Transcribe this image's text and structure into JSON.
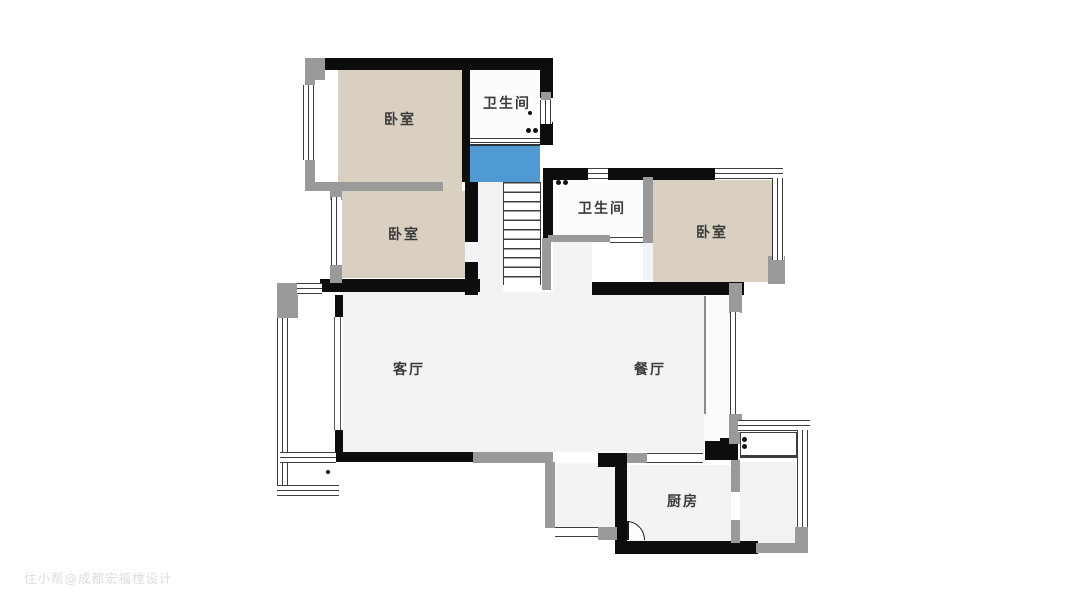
{
  "plan": {
    "watermark": "住小帮@成都宏福樘设计",
    "rooms": {
      "bedroom_top_left": "卧室",
      "bedroom_mid_left": "卧室",
      "bedroom_right": "卧室",
      "bathroom_top": "卫生间",
      "bathroom_mid": "卫生间",
      "living_room": "客厅",
      "dining_room": "餐厅",
      "kitchen": "厨房"
    },
    "colors": {
      "bedroom_fill": "#d9d0c1",
      "bath_fill": "#fbfcfd",
      "open_floor_fill": "#f2f3f5",
      "stair_landing_fill": "#4f9ad2",
      "wall_black": "#0d0d0d",
      "wall_gray": "#9a9a9a",
      "watermark_color": "#d8d5d0"
    }
  }
}
